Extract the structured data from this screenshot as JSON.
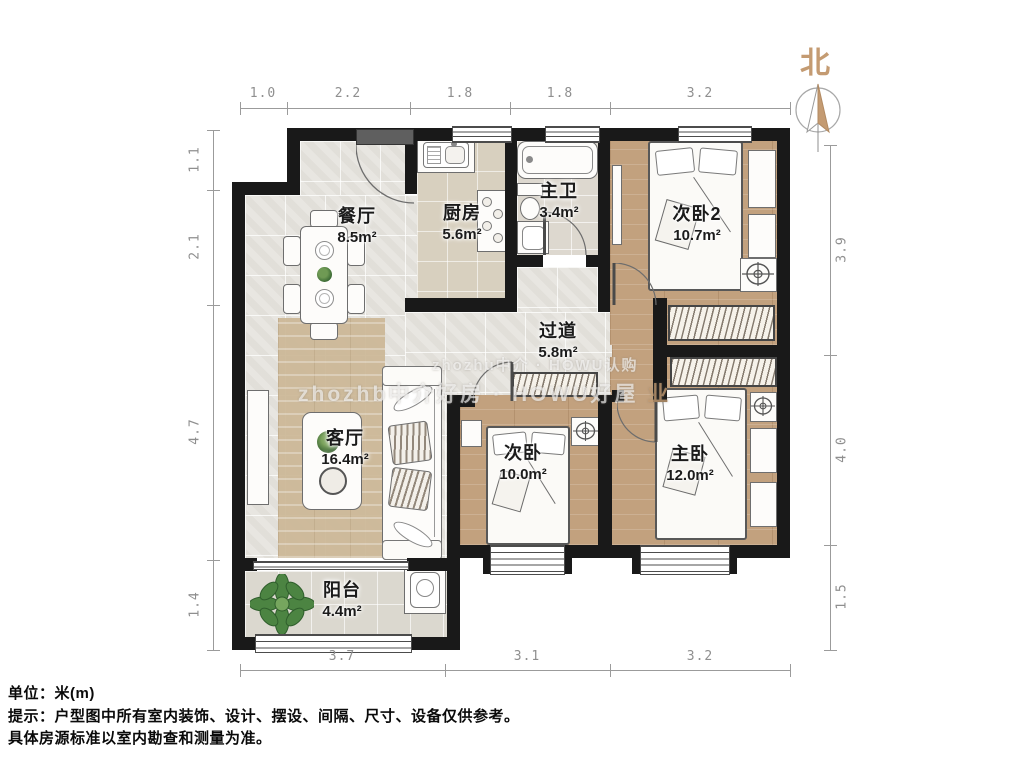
{
  "compass": {
    "label": "北"
  },
  "rooms": [
    {
      "name": "餐厅",
      "area": "8.5m²"
    },
    {
      "name": "厨房",
      "area": "5.6m²"
    },
    {
      "name": "主卫",
      "area": "3.4m²"
    },
    {
      "name": "次卧2",
      "area": "10.7m²"
    },
    {
      "name": "过道",
      "area": "5.8m²"
    },
    {
      "name": "客厅",
      "area": "16.4m²"
    },
    {
      "name": "次卧",
      "area": "10.0m²"
    },
    {
      "name": "主卧",
      "area": "12.0m²"
    },
    {
      "name": "阳台",
      "area": "4.4m²"
    }
  ],
  "dimensions": {
    "top": [
      "1.0",
      "2.2",
      "1.8",
      "1.8",
      "3.2"
    ],
    "left": [
      "1.1",
      "2.1",
      "4.7",
      "1.4"
    ],
    "right": [
      "3.9",
      "4.0",
      "1.5"
    ],
    "bottom": [
      "3.7",
      "3.1",
      "3.2"
    ]
  },
  "notes": {
    "unit": "单位：米(m)",
    "tip1": "提示：户型图中所有室内装饰、设计、摆设、间隔、尺寸、设备仅供参考。",
    "tip2": "具体房源标准以室内勘查和测量为准。"
  },
  "watermark": {
    "line1": "zhozhu中介 · HOWU认购",
    "line2": "zhozhb中介好房 · HOWU好屋",
    "logo": "业"
  },
  "colors": {
    "wall": "#191919",
    "wood_floor": "#c2a17e",
    "tile_floor": "#e8e6e1",
    "north_accent": "#c49b72"
  }
}
